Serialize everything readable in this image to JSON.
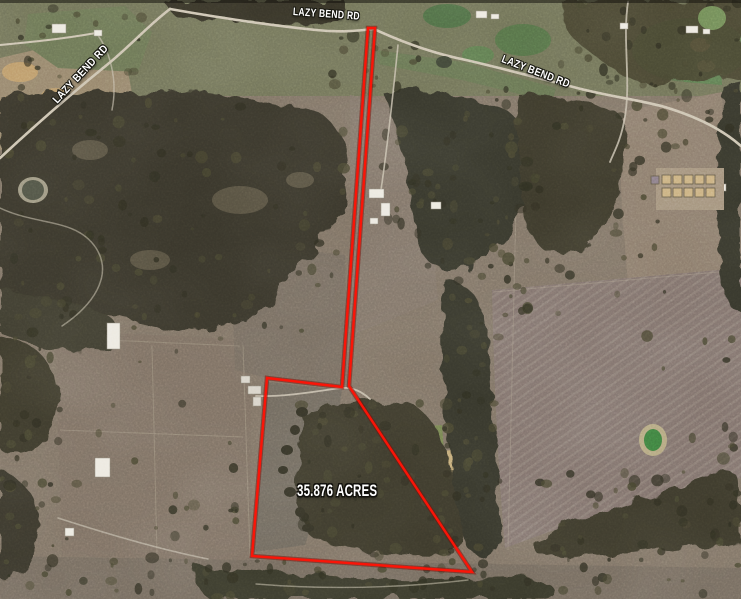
{
  "map": {
    "roads": {
      "top_label": "LAZY BEND RD",
      "left_label": "LAZY BEND RD",
      "right_label": "LAZY BEND RD"
    },
    "parcel": {
      "area_label": "35.876 ACRES",
      "boundary_color": "#fb1407"
    }
  }
}
